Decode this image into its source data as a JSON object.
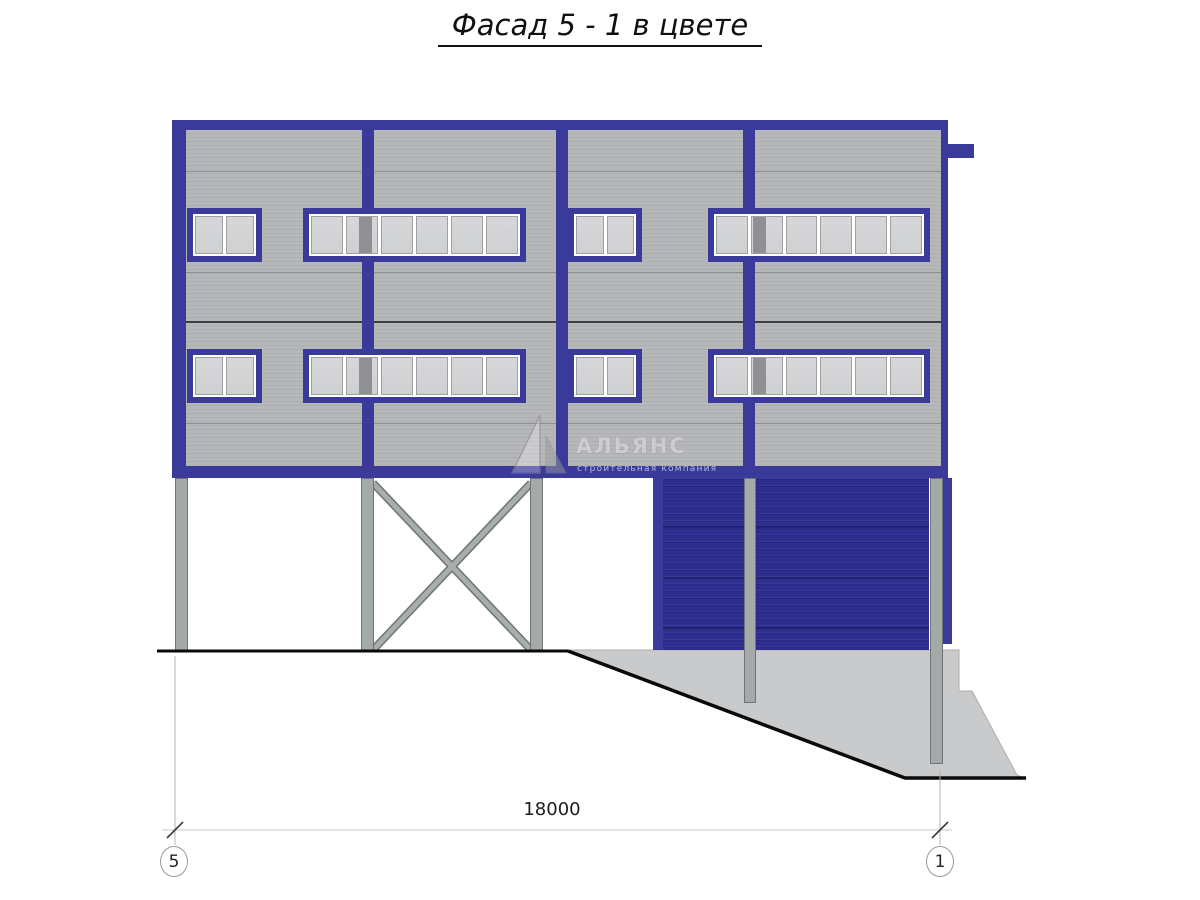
{
  "title": "Фасад 5 - 1 в цвете",
  "watermark": {
    "name": "АЛЬЯНС",
    "subtitle": "строительная компания",
    "logo": "sail-triangle-icon"
  },
  "dimension": {
    "value": "18000",
    "axis_left": "5",
    "axis_right": "1"
  },
  "drawing": {
    "type": "facade-elevation",
    "colors": {
      "frame_blue": "#3a3a9a",
      "garage_door_blue": "#2e2d90",
      "cladding_grey": "#b6b7b9",
      "concrete_grey": "#c9cacb",
      "window_glass": "#d2d3d5",
      "ground_line": "#0a0a0a"
    },
    "elements": {
      "storeys": 2,
      "window_rows": 2,
      "small_windows": {
        "count": 4,
        "panes_each": 2
      },
      "ribbon_windows": {
        "count": 4,
        "panes_each": 6
      },
      "garage_doors": {
        "count": 2,
        "sections_each": 4
      },
      "steel_piles": {
        "count": 5
      },
      "cross_bracing_bays": 1,
      "ground": "slopes down to the right onto concrete ramp"
    }
  }
}
